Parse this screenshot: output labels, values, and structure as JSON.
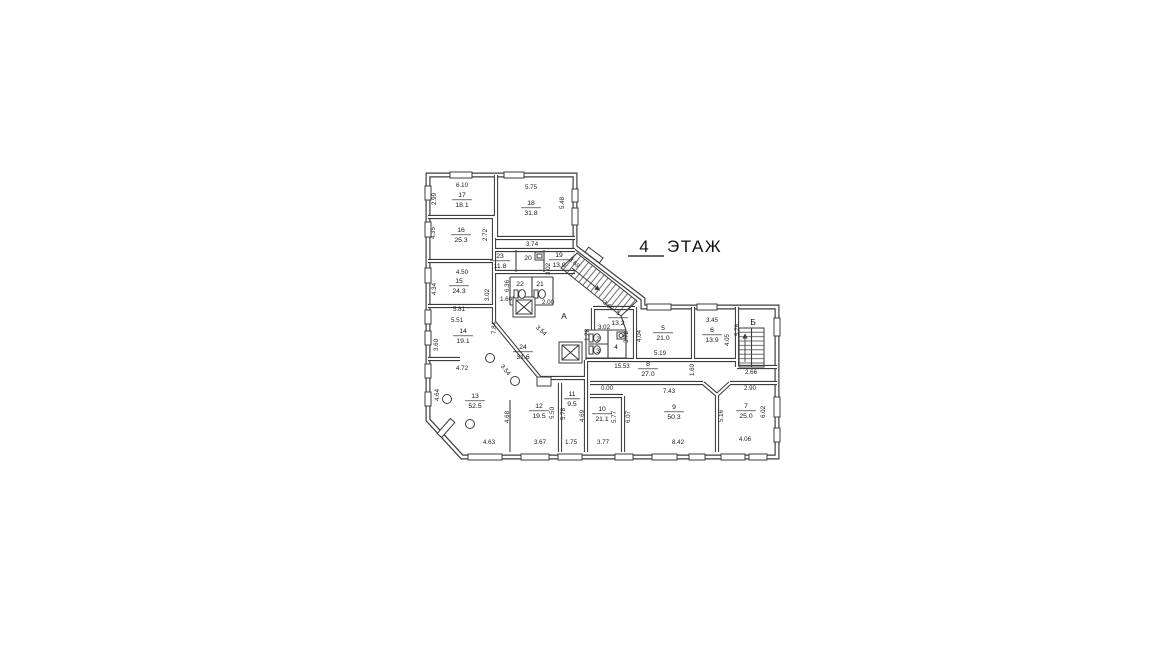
{
  "colors": {
    "background": "#ffffff",
    "line": "#3d3d3d",
    "text": "#141414"
  },
  "title": {
    "number": "4",
    "word": "ЭТАЖ"
  },
  "floor_plan": {
    "stairwells": [
      {
        "label": "А",
        "x": 564,
        "y": 319
      },
      {
        "label": "Б",
        "x": 753,
        "y": 325
      }
    ],
    "rooms": [
      {
        "number": "17",
        "area": "18.1",
        "x": 462,
        "y": 199
      },
      {
        "number": "18",
        "area": "31.8",
        "x": 531,
        "y": 207
      },
      {
        "number": "16",
        "area": "25.3",
        "x": 461,
        "y": 234
      },
      {
        "number": "23",
        "area": "11.8",
        "x": 500,
        "y": 260
      },
      {
        "number": "20",
        "area": "",
        "x": 528,
        "y": 258
      },
      {
        "number": "19",
        "area": "13.0",
        "x": 559,
        "y": 259
      },
      {
        "number": "22",
        "area": "",
        "x": 520,
        "y": 284
      },
      {
        "number": "21",
        "area": "",
        "x": 540,
        "y": 284
      },
      {
        "number": "15",
        "area": "24.3",
        "x": 459,
        "y": 285
      },
      {
        "number": "14",
        "area": "19.1",
        "x": 463,
        "y": 335
      },
      {
        "number": "24",
        "area": "31.6",
        "x": 523,
        "y": 351
      },
      {
        "number": "13",
        "area": "52.5",
        "x": 475,
        "y": 400
      },
      {
        "number": "12",
        "area": "19.5",
        "x": 539,
        "y": 410
      },
      {
        "number": "11",
        "area": "9.5",
        "x": 572,
        "y": 398
      },
      {
        "number": "10",
        "area": "21.1",
        "x": 602,
        "y": 413
      },
      {
        "number": "9",
        "area": "50.3",
        "x": 674,
        "y": 411
      },
      {
        "number": "8",
        "area": "27.0",
        "x": 648,
        "y": 368
      },
      {
        "number": "7",
        "area": "25.0",
        "x": 746,
        "y": 410
      },
      {
        "number": "6",
        "area": "13.9",
        "x": 712,
        "y": 334
      },
      {
        "number": "5",
        "area": "21.0",
        "x": 663,
        "y": 332
      },
      {
        "number": "1",
        "area": "13.2",
        "x": 618,
        "y": 317
      },
      {
        "number": "2",
        "area": "",
        "x": 598,
        "y": 339
      },
      {
        "number": "3",
        "area": "",
        "x": 598,
        "y": 351
      },
      {
        "number": "4",
        "area": "",
        "x": 616,
        "y": 347
      }
    ],
    "dimensions": [
      {
        "text": "6.10",
        "x": 462,
        "y": 187,
        "rot": 0
      },
      {
        "text": "5.75",
        "x": 531,
        "y": 189,
        "rot": 0
      },
      {
        "text": "2.99",
        "x": 436,
        "y": 199,
        "rot": -90
      },
      {
        "text": "5.48",
        "x": 564,
        "y": 203,
        "rot": -90
      },
      {
        "text": "4.35",
        "x": 435,
        "y": 233,
        "rot": -90
      },
      {
        "text": "2.72",
        "x": 487,
        "y": 235,
        "rot": -90
      },
      {
        "text": "3.74",
        "x": 532,
        "y": 246,
        "rot": 0
      },
      {
        "text": "3.02",
        "x": 550,
        "y": 269,
        "rot": -90
      },
      {
        "text": "3.69",
        "x": 573,
        "y": 264,
        "rot": 43
      },
      {
        "text": "6.36",
        "x": 509,
        "y": 286,
        "rot": -90
      },
      {
        "text": "4.50",
        "x": 462,
        "y": 274,
        "rot": 0
      },
      {
        "text": "4.34",
        "x": 436,
        "y": 289,
        "rot": -90
      },
      {
        "text": "3.02",
        "x": 489,
        "y": 295,
        "rot": -90
      },
      {
        "text": "1.60",
        "x": 506,
        "y": 301,
        "rot": 0
      },
      {
        "text": "2.00",
        "x": 548,
        "y": 304,
        "rot": 0
      },
      {
        "text": "5.81",
        "x": 459,
        "y": 311,
        "rot": 0
      },
      {
        "text": "5.51",
        "x": 457,
        "y": 322,
        "rot": 0
      },
      {
        "text": "7.84",
        "x": 496,
        "y": 328,
        "rot": -90
      },
      {
        "text": "3.60",
        "x": 438,
        "y": 345,
        "rot": -90
      },
      {
        "text": "3.60",
        "x": 607,
        "y": 307,
        "rot": 40
      },
      {
        "text": "3.54",
        "x": 540,
        "y": 332,
        "rot": 42
      },
      {
        "text": "3.54",
        "x": 504,
        "y": 371,
        "rot": 52
      },
      {
        "text": "4.72",
        "x": 462,
        "y": 370,
        "rot": 0
      },
      {
        "text": "4.64",
        "x": 439,
        "y": 395,
        "rot": -90
      },
      {
        "text": "4.68",
        "x": 509,
        "y": 417,
        "rot": -90
      },
      {
        "text": "5.50",
        "x": 554,
        "y": 413,
        "rot": -90
      },
      {
        "text": "5.78",
        "x": 565,
        "y": 414,
        "rot": -90
      },
      {
        "text": "4.69",
        "x": 584,
        "y": 416,
        "rot": -90
      },
      {
        "text": "4.63",
        "x": 489,
        "y": 444,
        "rot": 0
      },
      {
        "text": "3.67",
        "x": 540,
        "y": 444,
        "rot": 0
      },
      {
        "text": "1.75",
        "x": 571,
        "y": 444,
        "rot": 0
      },
      {
        "text": "3.77",
        "x": 603,
        "y": 444,
        "rot": 0
      },
      {
        "text": "0.00",
        "x": 607,
        "y": 390,
        "rot": 0
      },
      {
        "text": "5.77",
        "x": 616,
        "y": 417,
        "rot": -90
      },
      {
        "text": "6.07",
        "x": 630,
        "y": 417,
        "rot": -90
      },
      {
        "text": "7.43",
        "x": 669,
        "y": 393,
        "rot": 0
      },
      {
        "text": "8.42",
        "x": 678,
        "y": 444,
        "rot": 0
      },
      {
        "text": "5.16",
        "x": 723,
        "y": 416,
        "rot": -90
      },
      {
        "text": "6.02",
        "x": 765,
        "y": 412,
        "rot": -90
      },
      {
        "text": "4.06",
        "x": 745,
        "y": 441,
        "rot": 0
      },
      {
        "text": "2.90",
        "x": 750,
        "y": 390,
        "rot": 0
      },
      {
        "text": "2.66",
        "x": 751,
        "y": 374,
        "rot": 0
      },
      {
        "text": "15.53",
        "x": 622,
        "y": 368,
        "rot": 0
      },
      {
        "text": "1.60",
        "x": 694,
        "y": 370,
        "rot": -90
      },
      {
        "text": "5.19",
        "x": 660,
        "y": 355,
        "rot": 0
      },
      {
        "text": "4.04",
        "x": 641,
        "y": 336,
        "rot": -90
      },
      {
        "text": "3.72",
        "x": 628,
        "y": 337,
        "rot": -90
      },
      {
        "text": "3.02",
        "x": 604,
        "y": 329,
        "rot": 0
      },
      {
        "text": "1.28",
        "x": 589,
        "y": 335,
        "rot": -90
      },
      {
        "text": "3.45",
        "x": 712,
        "y": 322,
        "rot": 0
      },
      {
        "text": "4.05",
        "x": 729,
        "y": 340,
        "rot": -90
      },
      {
        "text": "5.76",
        "x": 739,
        "y": 330,
        "rot": -90
      }
    ]
  }
}
